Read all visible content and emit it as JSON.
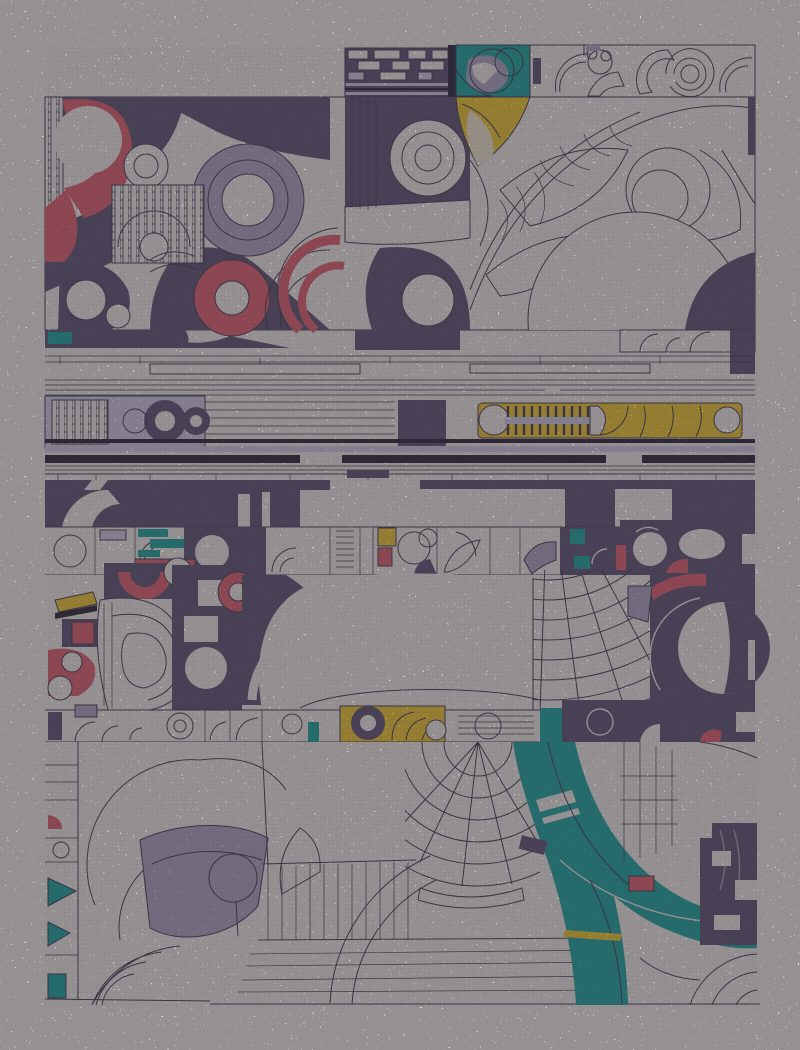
{
  "artwork": {
    "kind": "abstract-generative-collage",
    "palette": {
      "paper": "#f2efe1",
      "ink": "#3a3444",
      "ink2": "#201c27",
      "dark": "#564f67",
      "red": "#e05b60",
      "teal": "#10a294",
      "yellow": "#f2c71f",
      "lav": "#a9a3b8",
      "lavlt": "#cfcbdb"
    }
  }
}
